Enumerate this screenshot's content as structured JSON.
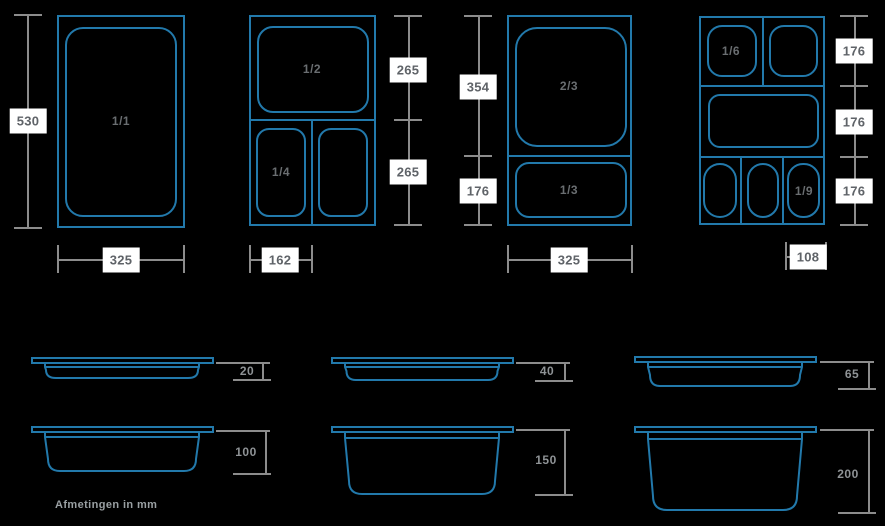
{
  "colors": {
    "background": "#000000",
    "pan_stroke": "#2279ab",
    "dim_stroke": "#8c8c8c",
    "dim_label_bg": "#ffffff",
    "dim_label_text": "#5f6368",
    "pan_label_text": "#6a6e71",
    "depth_label_text": "#8f9396",
    "footnote_text": "#9aa0a3"
  },
  "footnote": "Afmetingen in mm",
  "top_row": [
    {
      "name": "gn-1-1",
      "cells": [
        "1/1"
      ],
      "height_dims": [
        "530"
      ],
      "width_dim": "325"
    },
    {
      "name": "gn-1-2-1-4",
      "cells": [
        "1/2",
        "1/4"
      ],
      "height_dims": [
        "265",
        "265"
      ],
      "width_dim": "162"
    },
    {
      "name": "gn-2-3-1-3",
      "cells": [
        "2/3",
        "1/3"
      ],
      "height_dims": [
        "354",
        "176"
      ],
      "width_dim": "325"
    },
    {
      "name": "gn-1-6-1-9",
      "cells": [
        "1/6",
        "1/9"
      ],
      "height_dims": [
        "176",
        "176",
        "176"
      ],
      "width_dim": "108"
    }
  ],
  "depth_row": [
    "20",
    "40",
    "65",
    "100",
    "150",
    "200"
  ]
}
